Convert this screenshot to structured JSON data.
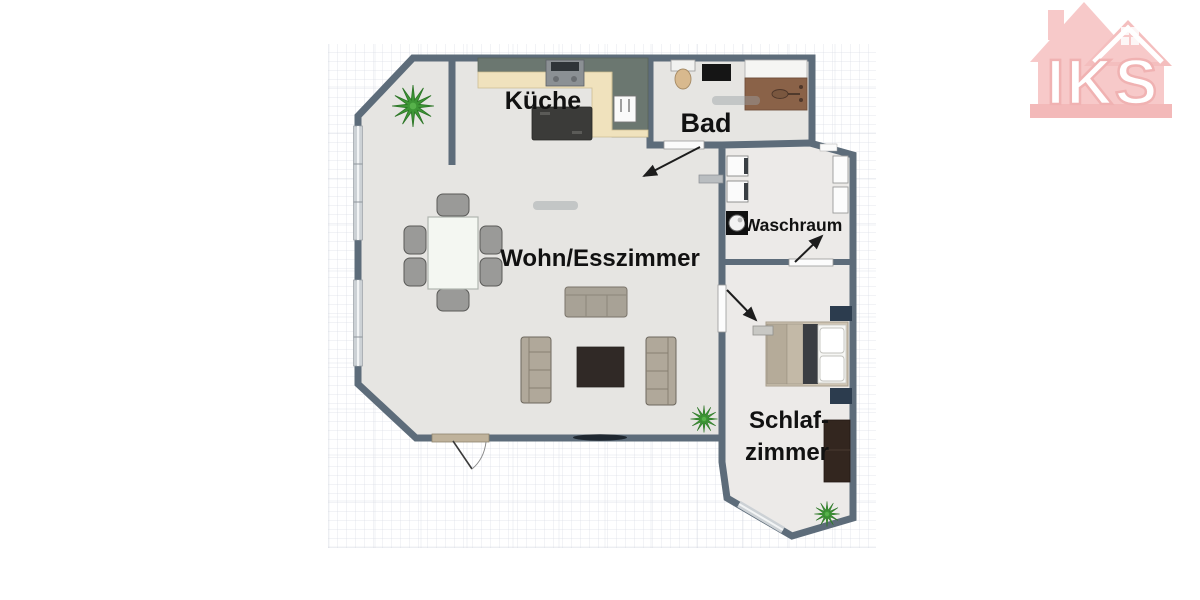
{
  "title": "Apartment floor plan",
  "logo": {
    "text": "IKS",
    "color": "#f6c2c2"
  },
  "rooms": {
    "kueche": {
      "label": "Küche"
    },
    "bad": {
      "label": "Bad"
    },
    "wohnesszimmer": {
      "label": "Wohn/Esszimmer"
    },
    "waschraum": {
      "label": "Waschraum"
    },
    "schlafzimmer": {
      "label_line1": "Schlaf-",
      "label_line2": "zimmer"
    }
  },
  "colors": {
    "wall": "#5d6c7a",
    "floor_main": "#e6e5e2",
    "floor_wing": "#eceae8",
    "window": "#ccd1d5",
    "counter_beige": "#f0e2bd",
    "cabinet_green_gray": "#6b7770",
    "vanity_wood": "#8a6248",
    "plant_green": "#3d9635",
    "label_text": "#111111"
  },
  "furniture_icons": [
    "dining-table",
    "dining-chair",
    "three-seat-sofa",
    "loveseat",
    "rug",
    "kitchen-island",
    "stove",
    "fridge",
    "toilet",
    "shower-mat",
    "bathtub-vanity",
    "washing-machine",
    "washer-dryer-stack",
    "closet",
    "bed",
    "pillow",
    "bench",
    "nightstand",
    "wardrobe",
    "plant",
    "door-swing",
    "door-arrow",
    "window"
  ]
}
